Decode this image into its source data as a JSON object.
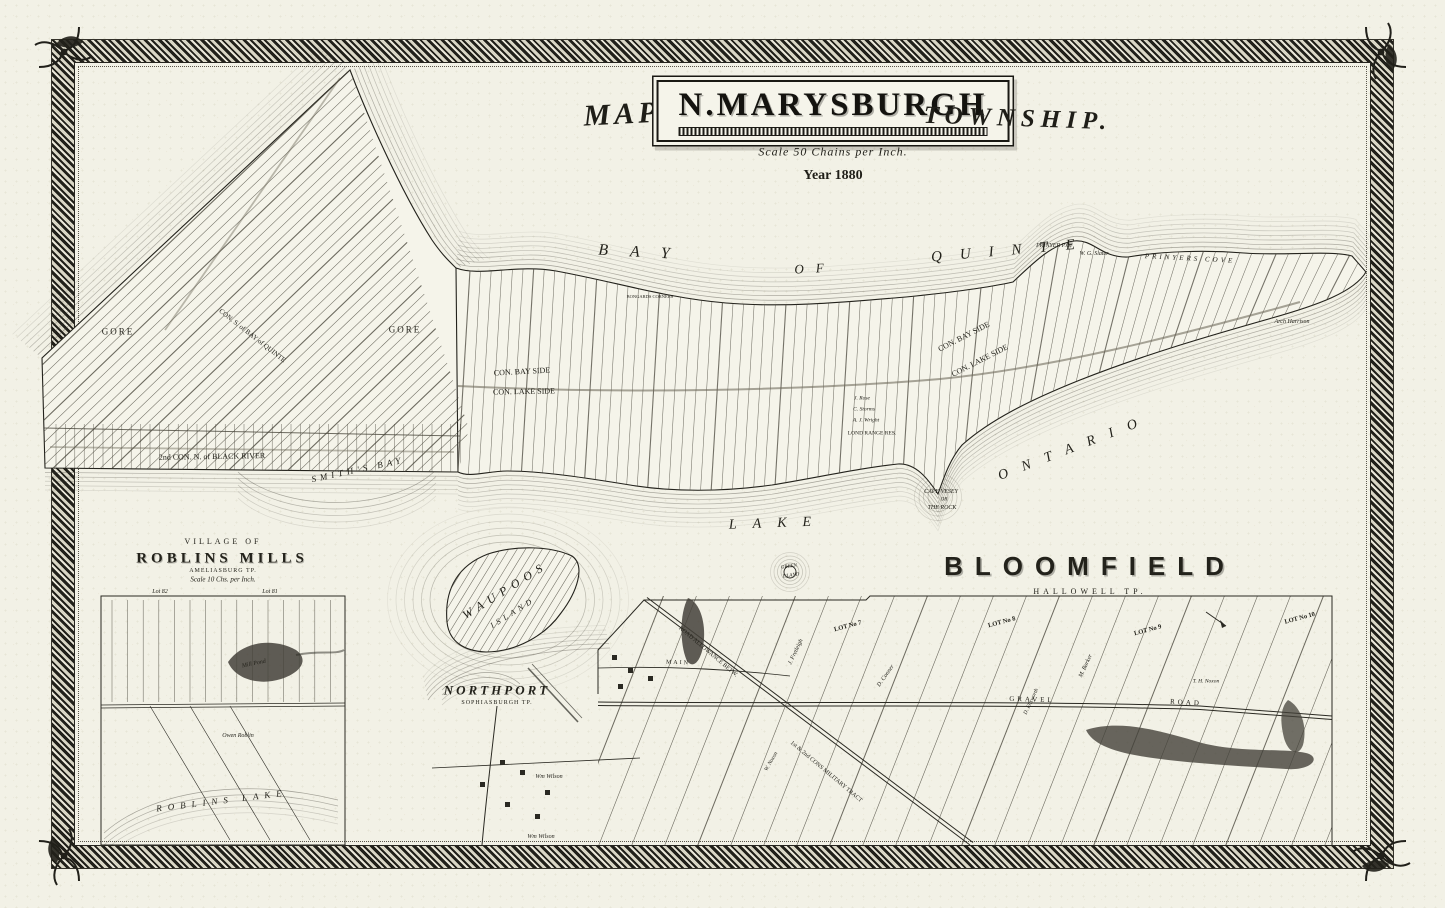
{
  "title": {
    "prefix": "MAP OF",
    "name": "N.MARYSBURGH",
    "suffix": "TOWNSHIP.",
    "scale": "Scale 50 Chains per Inch.",
    "year": "Year 1880"
  },
  "labels": [
    {
      "t": "BAY",
      "x": 645,
      "y": 253,
      "s": 16,
      "ls": 22,
      "i": 1,
      "r": 3
    },
    {
      "t": "OF",
      "x": 815,
      "y": 268,
      "s": 13,
      "ls": 12,
      "i": 1,
      "r": -3
    },
    {
      "t": "QUINTE",
      "x": 1012,
      "y": 251,
      "s": 15,
      "ls": 18,
      "i": 1,
      "r": -5
    },
    {
      "t": "LAKE",
      "x": 778,
      "y": 524,
      "s": 14,
      "ls": 16,
      "i": 1,
      "r": -2
    },
    {
      "t": "ONTARIO",
      "x": 1075,
      "y": 448,
      "s": 14,
      "ls": 15,
      "i": 1,
      "r": -21
    },
    {
      "t": "SMITH'S BAY",
      "x": 358,
      "y": 470,
      "s": 9,
      "ls": 4,
      "i": 1,
      "r": -12
    },
    {
      "t": "WAUPOOS",
      "x": 505,
      "y": 590,
      "s": 12,
      "ls": 6,
      "i": 1,
      "r": -32
    },
    {
      "t": "ISLAND",
      "x": 513,
      "y": 613,
      "s": 8,
      "ls": 4,
      "i": 1,
      "r": -32
    },
    {
      "t": "GREEN",
      "x": 789,
      "y": 567,
      "s": 5,
      "i": 1,
      "r": -8
    },
    {
      "t": "ISLAND",
      "x": 791,
      "y": 576,
      "s": 5,
      "i": 1,
      "r": -8
    },
    {
      "t": "CAPE VESEY",
      "x": 941,
      "y": 492,
      "s": 6,
      "i": 1
    },
    {
      "t": "OR",
      "x": 944,
      "y": 500,
      "s": 5,
      "i": 1
    },
    {
      "t": "THE ROCK",
      "x": 942,
      "y": 508,
      "s": 6,
      "i": 1
    },
    {
      "t": "PRINYERS COVE",
      "x": 1190,
      "y": 259,
      "s": 7,
      "ls": 3,
      "i": 1,
      "r": 3
    },
    {
      "t": "PRINYER P.O.",
      "x": 1054,
      "y": 246,
      "s": 6,
      "i": 1
    },
    {
      "t": "W. G. Slater",
      "x": 1094,
      "y": 254,
      "s": 6,
      "i": 1
    },
    {
      "t": "2nd CON. N. of BLACK RIVER",
      "x": 212,
      "y": 457,
      "s": 8,
      "r": -1
    },
    {
      "t": "CON. BAY SIDE",
      "x": 522,
      "y": 372,
      "s": 8,
      "r": -3
    },
    {
      "t": "CON. LAKE SIDE",
      "x": 524,
      "y": 392,
      "s": 8,
      "r": -1
    },
    {
      "t": "CON. BAY SIDE",
      "x": 964,
      "y": 337,
      "s": 8,
      "r": -27
    },
    {
      "t": "CON. LAKE SIDE",
      "x": 980,
      "y": 361,
      "s": 8,
      "r": -27
    },
    {
      "t": "GORE",
      "x": 118,
      "y": 332,
      "s": 9,
      "ls": 2
    },
    {
      "t": "GORE",
      "x": 405,
      "y": 330,
      "s": 9,
      "ls": 2
    },
    {
      "t": "CON. S. of BAY of QUINTE",
      "x": 252,
      "y": 336,
      "s": 7,
      "r": 38
    },
    {
      "t": "BONGARDS CORNERS",
      "x": 650,
      "y": 297,
      "s": 4.5
    },
    {
      "t": "Arch Harrison",
      "x": 1292,
      "y": 322,
      "s": 6,
      "i": 1
    },
    {
      "t": "J. Rose",
      "x": 862,
      "y": 399,
      "s": 5.5,
      "i": 1
    },
    {
      "t": "C. Storms",
      "x": 864,
      "y": 410,
      "s": 5.5,
      "i": 1
    },
    {
      "t": "A. J. Wright",
      "x": 866,
      "y": 421,
      "s": 5.5,
      "i": 1
    },
    {
      "t": "LOND RANGE RES.",
      "x": 872,
      "y": 434,
      "s": 5.5
    },
    {
      "t": "BLOOMFIELD",
      "x": 1090,
      "y": 566,
      "s": 26,
      "ls": 12,
      "w": 700,
      "cls": "engrave"
    },
    {
      "t": "HALLOWELL TP.",
      "x": 1090,
      "y": 592,
      "s": 8,
      "ls": 4
    },
    {
      "t": "GRAVEL",
      "x": 1032,
      "y": 700,
      "s": 7,
      "ls": 3,
      "r": 2
    },
    {
      "t": "ROAD",
      "x": 1186,
      "y": 703,
      "s": 7,
      "ls": 3,
      "r": 3
    },
    {
      "t": "MAIN",
      "x": 678,
      "y": 663,
      "s": 6,
      "ls": 2,
      "r": 2
    },
    {
      "t": "ROAD ALLOWANCE BETW.",
      "x": 708,
      "y": 652,
      "s": 6,
      "r": 40
    },
    {
      "t": "1st & 2nd CONS MILITARY TRACT",
      "x": 826,
      "y": 772,
      "s": 6,
      "r": 40
    },
    {
      "t": "LOT No 7",
      "x": 848,
      "y": 627,
      "s": 6.5,
      "w": 700,
      "r": -15
    },
    {
      "t": "LOT No 8",
      "x": 1002,
      "y": 623,
      "s": 6.5,
      "w": 700,
      "r": -15
    },
    {
      "t": "LOT No 9",
      "x": 1148,
      "y": 631,
      "s": 6.5,
      "w": 700,
      "r": -15
    },
    {
      "t": "LOT No 10",
      "x": 1300,
      "y": 619,
      "s": 6.5,
      "w": 700,
      "r": -15
    },
    {
      "t": "J. Fretleigh",
      "x": 796,
      "y": 652,
      "s": 6,
      "i": 1,
      "r": -65
    },
    {
      "t": "D. Conner",
      "x": 886,
      "y": 676,
      "s": 6,
      "i": 1,
      "r": -55
    },
    {
      "t": "M. Barker",
      "x": 1086,
      "y": 666,
      "s": 6,
      "i": 1,
      "r": -65
    },
    {
      "t": "D. Ellsworth",
      "x": 1032,
      "y": 702,
      "s": 5.5,
      "i": 1,
      "r": -65
    },
    {
      "t": "W. Noxon",
      "x": 772,
      "y": 762,
      "s": 5.5,
      "i": 1,
      "r": -60
    },
    {
      "t": "T. H. Noxon",
      "x": 1206,
      "y": 682,
      "s": 5.5,
      "i": 1
    },
    {
      "t": "VILLAGE OF",
      "x": 223,
      "y": 542,
      "s": 8,
      "ls": 3
    },
    {
      "t": "ROBLINS MILLS",
      "x": 222,
      "y": 559,
      "s": 15,
      "ls": 4,
      "w": 700,
      "cls": "engrave2"
    },
    {
      "t": "AMELIASBURG TP.",
      "x": 223,
      "y": 571,
      "s": 6,
      "ls": 1
    },
    {
      "t": "Scale 10 Chs. per Inch.",
      "x": 223,
      "y": 580,
      "s": 7,
      "i": 1
    },
    {
      "t": "Lot 82",
      "x": 160,
      "y": 592,
      "s": 6,
      "i": 1
    },
    {
      "t": "Lot 81",
      "x": 270,
      "y": 592,
      "s": 6,
      "i": 1
    },
    {
      "t": "Mill Pond",
      "x": 254,
      "y": 664,
      "s": 6,
      "i": 1,
      "r": -12
    },
    {
      "t": "Owen Roblin",
      "x": 238,
      "y": 736,
      "s": 6,
      "i": 1
    },
    {
      "t": "ROBLINS LAKE",
      "x": 222,
      "y": 801,
      "s": 9,
      "ls": 6,
      "i": 1,
      "r": -7
    },
    {
      "t": "NORTHPORT",
      "x": 497,
      "y": 690,
      "s": 13,
      "ls": 3,
      "i": 1,
      "w": 600
    },
    {
      "t": "SOPHIASBURGH TP.",
      "x": 497,
      "y": 703,
      "s": 6,
      "ls": 1
    },
    {
      "t": "Wm Wilson",
      "x": 549,
      "y": 777,
      "s": 6,
      "i": 1
    },
    {
      "t": "Wm Wilson",
      "x": 541,
      "y": 837,
      "s": 6,
      "i": 1
    }
  ]
}
